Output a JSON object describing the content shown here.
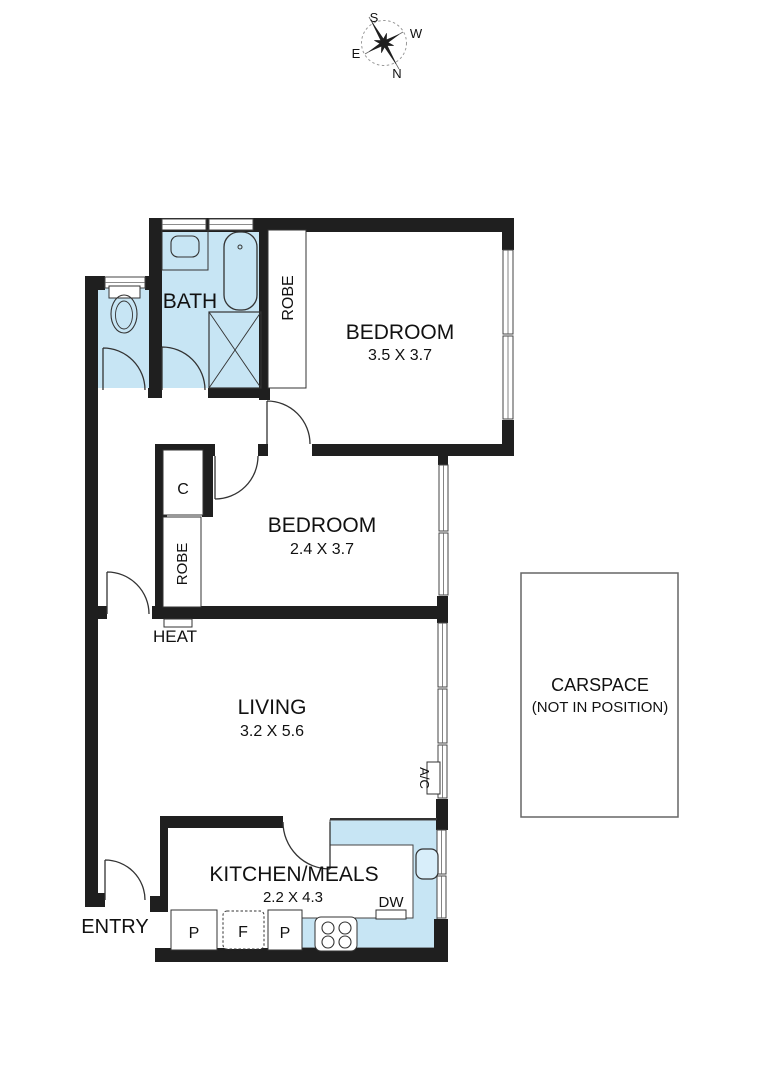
{
  "compass": {
    "south": "S",
    "west": "W",
    "east": "E",
    "north": "N"
  },
  "rooms": {
    "bath": {
      "label": "BATH"
    },
    "bedroom1": {
      "label": "BEDROOM",
      "dims": "3.5 X 3.7"
    },
    "bedroom2": {
      "label": "BEDROOM",
      "dims": "2.4 X 3.7"
    },
    "living": {
      "label": "LIVING",
      "dims": "3.2 X 5.6"
    },
    "kitchen": {
      "label": "KITCHEN/MEALS",
      "dims": "2.2 X 4.3"
    },
    "entry": {
      "label": "ENTRY"
    },
    "carspace": {
      "label": "CARSPACE",
      "sublabel": "(NOT IN POSITION)"
    }
  },
  "fixtures": {
    "robe_bedroom1": "ROBE",
    "robe_bedroom2": "ROBE",
    "cupboard": "C",
    "heater": "HEAT",
    "air_conditioner": "A/C",
    "dishwasher": "DW",
    "pantry_left": "P",
    "fridge": "F",
    "pantry_right": "P"
  },
  "colors": {
    "wet_area": "#c7e5f4",
    "wall": "#1f1f1f",
    "line": "#333333"
  }
}
